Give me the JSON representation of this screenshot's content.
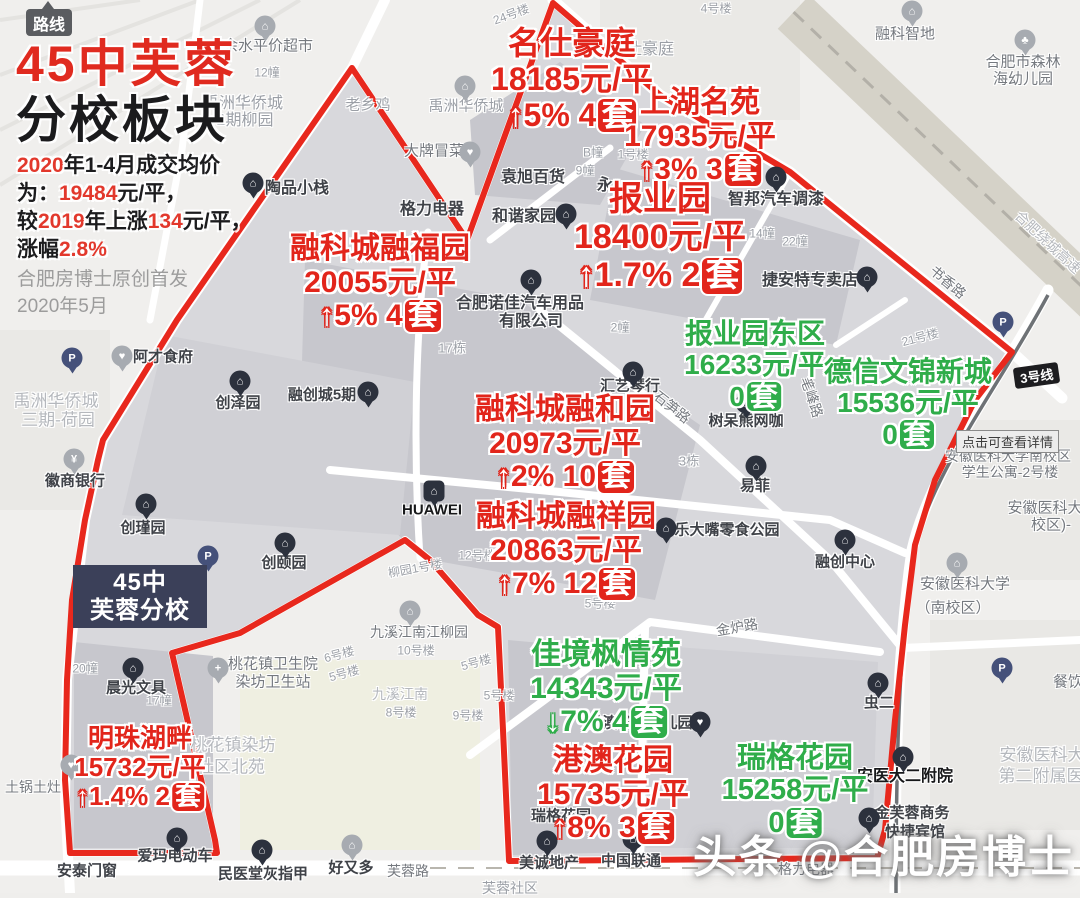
{
  "colors": {
    "red": "#e2251b",
    "green": "#2fad4a",
    "boundary": "#e8281d",
    "school_bg": "#3b4059"
  },
  "route_button": {
    "label": "路线"
  },
  "header": {
    "title_red": "45中芙蓉",
    "title_black": "分校板块",
    "summary_lines": [
      [
        {
          "t": "2020",
          "c": "r"
        },
        {
          "t": "年1-4月成交均价",
          "c": "k"
        }
      ],
      [
        {
          "t": "为：",
          "c": "k"
        },
        {
          "t": "19484",
          "c": "r"
        },
        {
          "t": "元/平，",
          "c": "k"
        }
      ],
      [
        {
          "t": "较",
          "c": "k"
        },
        {
          "t": "2019",
          "c": "r"
        },
        {
          "t": "年上涨",
          "c": "k"
        },
        {
          "t": "134",
          "c": "r"
        },
        {
          "t": "元/平，",
          "c": "k"
        }
      ],
      [
        {
          "t": "涨幅",
          "c": "k"
        },
        {
          "t": "2.8%",
          "c": "r"
        }
      ]
    ],
    "credit_lines": [
      "合肥房博士原创首发",
      "2020年5月"
    ]
  },
  "school_box": {
    "line1": "45中",
    "line2": "芙蓉分校"
  },
  "metro_badge": {
    "label": "3号线"
  },
  "detail_tooltip": {
    "label": "点击可查看详情"
  },
  "watermark": {
    "label": "头条 @合肥房博士"
  },
  "estates": [
    {
      "name": "名仕豪庭",
      "price": "18185元/平",
      "trend": "up",
      "change": "5%",
      "count": "4",
      "unit": "套",
      "color": "red",
      "cx": 572,
      "y": 26,
      "fs": 32
    },
    {
      "name": "上湖名苑",
      "price": "17935元/平",
      "trend": "up",
      "change": "3%",
      "count": "3",
      "unit": "套",
      "color": "red",
      "cx": 700,
      "y": 86,
      "fs": 30
    },
    {
      "name": "报业园",
      "price": "18400元/平",
      "trend": "up",
      "change": "1.7%",
      "count": "2",
      "unit": "套",
      "color": "red",
      "cx": 660,
      "y": 180,
      "fs": 34
    },
    {
      "name": "融科城融福园",
      "price": "20055元/平",
      "trend": "up",
      "change": "5%",
      "count": "4",
      "unit": "套",
      "color": "red",
      "cx": 380,
      "y": 232,
      "fs": 30
    },
    {
      "name": "报业园东区",
      "price": "16233元/平",
      "trend": "none",
      "change": "",
      "count": "0",
      "unit": "套",
      "color": "green",
      "cx": 755,
      "y": 318,
      "fs": 28
    },
    {
      "name": "德信文锦新城",
      "price": "15536元/平",
      "trend": "none",
      "change": "",
      "count": "0",
      "unit": "套",
      "color": "green",
      "cx": 908,
      "y": 356,
      "fs": 28
    },
    {
      "name": "融科城融和园",
      "price": "20973元/平",
      "trend": "up",
      "change": "2%",
      "count": "10",
      "unit": "套",
      "color": "red",
      "cx": 565,
      "y": 393,
      "fs": 30
    },
    {
      "name": "融科城融祥园",
      "price": "20863元/平",
      "trend": "up",
      "change": "7%",
      "count": "12",
      "unit": "套",
      "color": "red",
      "cx": 566,
      "y": 500,
      "fs": 30
    },
    {
      "name": "佳境枫情苑",
      "price": "14343元/平",
      "trend": "down",
      "change": "7%",
      "count": "4",
      "unit": "套",
      "color": "green",
      "cx": 606,
      "y": 638,
      "fs": 30
    },
    {
      "name": "港澳花园",
      "price": "15735元/平",
      "trend": "up",
      "change": "8%",
      "count": "3",
      "unit": "套",
      "color": "red",
      "cx": 613,
      "y": 744,
      "fs": 30
    },
    {
      "name": "瑞格花园",
      "price": "15258元/平",
      "trend": "none",
      "change": "",
      "count": "0",
      "unit": "套",
      "color": "green",
      "cx": 795,
      "y": 742,
      "fs": 29
    },
    {
      "name": "明珠湖畔",
      "price": "15732元/平",
      "trend": "up",
      "change": "1.4%",
      "count": "2",
      "unit": "套",
      "color": "red",
      "cx": 140,
      "y": 724,
      "fs": 26
    }
  ],
  "map_labels": [
    {
      "t": "余水平价超市",
      "x": 268,
      "y": 45,
      "fs": 15,
      "c": "gray2"
    },
    {
      "t": "禹洲华侨城",
      "x": 243,
      "y": 101,
      "fs": 16,
      "c": "gray"
    },
    {
      "t": "2期柳园",
      "x": 245,
      "y": 118,
      "fs": 16,
      "c": "gray"
    },
    {
      "t": "12幢",
      "x": 267,
      "y": 72,
      "fs": 12,
      "c": "gray"
    },
    {
      "t": "24号楼",
      "x": 511,
      "y": 14,
      "fs": 12,
      "c": "gray",
      "rot": -20
    },
    {
      "t": "4号楼",
      "x": 716,
      "y": 8,
      "fs": 12,
      "c": "gray"
    },
    {
      "t": "融科智地",
      "x": 905,
      "y": 33,
      "fs": 15,
      "c": "gray2"
    },
    {
      "t": "合肥市森林",
      "x": 1023,
      "y": 61,
      "fs": 15,
      "c": "gray2"
    },
    {
      "t": "海幼儿园",
      "x": 1023,
      "y": 78,
      "fs": 15,
      "c": "gray2"
    },
    {
      "t": "老乡鸡",
      "x": 368,
      "y": 104,
      "fs": 15,
      "c": "gray"
    },
    {
      "t": "仕豪庭",
      "x": 650,
      "y": 47,
      "fs": 16,
      "c": "gray"
    },
    {
      "t": "大牌冒菜",
      "x": 434,
      "y": 150,
      "fs": 15,
      "c": "gray2"
    },
    {
      "t": "陶品小栈",
      "x": 297,
      "y": 186,
      "fs": 16,
      "c": "dark"
    },
    {
      "t": "袁旭百货",
      "x": 533,
      "y": 175,
      "fs": 16,
      "c": "dark"
    },
    {
      "t": "B幢",
      "x": 593,
      "y": 152,
      "fs": 12,
      "c": "gray"
    },
    {
      "t": "9幢",
      "x": 585,
      "y": 170,
      "fs": 12,
      "c": "gray"
    },
    {
      "t": "1号楼",
      "x": 633,
      "y": 154,
      "fs": 12,
      "c": "gray"
    },
    {
      "t": "永",
      "x": 605,
      "y": 183,
      "fs": 16,
      "c": "dark"
    },
    {
      "t": "和谐家园",
      "x": 524,
      "y": 214,
      "fs": 16,
      "c": "dark"
    },
    {
      "t": "格力电器",
      "x": 432,
      "y": 207,
      "fs": 16,
      "c": "dark"
    },
    {
      "t": "智邦汽车调漆",
      "x": 776,
      "y": 197,
      "fs": 16,
      "c": "dark"
    },
    {
      "t": "14幢",
      "x": 762,
      "y": 233,
      "fs": 12,
      "c": "gray"
    },
    {
      "t": "22幢",
      "x": 795,
      "y": 241,
      "fs": 12,
      "c": "gray"
    },
    {
      "t": "捷安特专卖店",
      "x": 810,
      "y": 278,
      "fs": 16,
      "c": "dark"
    },
    {
      "t": "书香路",
      "x": 948,
      "y": 282,
      "fs": 14,
      "c": "gray2",
      "rot": 40
    },
    {
      "t": "合肥绕城高速",
      "x": 1048,
      "y": 242,
      "fs": 14,
      "c": "gray3",
      "rot": 43
    },
    {
      "t": "21号楼",
      "x": 920,
      "y": 337,
      "fs": 12,
      "c": "gray",
      "rot": -15
    },
    {
      "t": "2幢",
      "x": 620,
      "y": 327,
      "fs": 12,
      "c": "gray"
    },
    {
      "t": "合肥诺佳汽车用品",
      "x": 520,
      "y": 301,
      "fs": 16,
      "c": "dark"
    },
    {
      "t": "有限公司",
      "x": 531,
      "y": 319,
      "fs": 16,
      "c": "dark"
    },
    {
      "t": "17栋",
      "x": 452,
      "y": 347,
      "fs": 13,
      "c": "gray"
    },
    {
      "t": "禹洲华侨城",
      "x": 466,
      "y": 105,
      "fs": 15,
      "c": "gray"
    },
    {
      "t": "汇艺琴行",
      "x": 630,
      "y": 385,
      "fs": 15,
      "c": "dark"
    },
    {
      "t": "石笋路",
      "x": 672,
      "y": 407,
      "fs": 14,
      "c": "gray2",
      "rot": 38
    },
    {
      "t": "树呆熊网咖",
      "x": 746,
      "y": 420,
      "fs": 15,
      "c": "dark"
    },
    {
      "t": "笔峰路",
      "x": 812,
      "y": 397,
      "fs": 14,
      "c": "gray2",
      "rot": 72
    },
    {
      "t": "3栋",
      "x": 689,
      "y": 460,
      "fs": 13,
      "c": "gray"
    },
    {
      "t": "易菲",
      "x": 755,
      "y": 485,
      "fs": 15,
      "c": "dark"
    },
    {
      "t": "乐大嘴零食公园",
      "x": 727,
      "y": 529,
      "fs": 15,
      "c": "dark"
    },
    {
      "t": "融创中心",
      "x": 845,
      "y": 561,
      "fs": 15,
      "c": "dark"
    },
    {
      "t": "融创城5期",
      "x": 322,
      "y": 394,
      "fs": 15,
      "c": "dark"
    },
    {
      "t": "创泽园",
      "x": 238,
      "y": 402,
      "fs": 15,
      "c": "dark"
    },
    {
      "t": "阿才食府",
      "x": 163,
      "y": 356,
      "fs": 15,
      "c": "dark"
    },
    {
      "t": "禹洲华侨城",
      "x": 56,
      "y": 399,
      "fs": 17,
      "c": "gray3"
    },
    {
      "t": "三期-荷园",
      "x": 58,
      "y": 418,
      "fs": 17,
      "c": "gray3"
    },
    {
      "t": "徽商银行",
      "x": 75,
      "y": 480,
      "fs": 15,
      "c": "dark"
    },
    {
      "t": "创瑾园",
      "x": 143,
      "y": 527,
      "fs": 15,
      "c": "dark"
    },
    {
      "t": "创颐园",
      "x": 284,
      "y": 562,
      "fs": 15,
      "c": "dark"
    },
    {
      "t": "HUAWEI",
      "x": 432,
      "y": 510,
      "fs": 15,
      "c": "black"
    },
    {
      "t": "12号楼",
      "x": 477,
      "y": 555,
      "fs": 12,
      "c": "gray"
    },
    {
      "t": "柳园1号楼",
      "x": 415,
      "y": 568,
      "fs": 12,
      "c": "gray",
      "rot": -10
    },
    {
      "t": "5号楼",
      "x": 600,
      "y": 603,
      "fs": 12,
      "c": "gray"
    },
    {
      "t": "九溪江南江柳园",
      "x": 419,
      "y": 632,
      "fs": 14,
      "c": "gray2"
    },
    {
      "t": "10号楼",
      "x": 416,
      "y": 650,
      "fs": 12,
      "c": "gray"
    },
    {
      "t": "5号楼",
      "x": 476,
      "y": 662,
      "fs": 12,
      "c": "gray",
      "rot": -15
    },
    {
      "t": "5号楼",
      "x": 499,
      "y": 695,
      "fs": 12,
      "c": "gray"
    },
    {
      "t": "9号楼",
      "x": 468,
      "y": 715,
      "fs": 12,
      "c": "gray"
    },
    {
      "t": "九溪江南",
      "x": 400,
      "y": 694,
      "fs": 14,
      "c": "gray3"
    },
    {
      "t": "8号楼",
      "x": 401,
      "y": 712,
      "fs": 12,
      "c": "gray"
    },
    {
      "t": "6号楼",
      "x": 339,
      "y": 654,
      "fs": 12,
      "c": "gray",
      "rot": -15
    },
    {
      "t": "5号楼",
      "x": 344,
      "y": 673,
      "fs": 12,
      "c": "gray",
      "rot": -15
    },
    {
      "t": "桃花镇卫生院",
      "x": 273,
      "y": 663,
      "fs": 15,
      "c": "gray2"
    },
    {
      "t": "染坊卫生站",
      "x": 273,
      "y": 681,
      "fs": 15,
      "c": "gray2"
    },
    {
      "t": "桃花镇染坊",
      "x": 233,
      "y": 743,
      "fs": 17,
      "c": "gray3"
    },
    {
      "t": "社区北苑",
      "x": 231,
      "y": 765,
      "fs": 17,
      "c": "gray3"
    },
    {
      "t": "17幢",
      "x": 159,
      "y": 700,
      "fs": 12,
      "c": "gray"
    },
    {
      "t": "20幢",
      "x": 85,
      "y": 668,
      "fs": 12,
      "c": "gray"
    },
    {
      "t": "晨光文具",
      "x": 136,
      "y": 687,
      "fs": 15,
      "c": "dark"
    },
    {
      "t": "土锅土灶",
      "x": 33,
      "y": 787,
      "fs": 14,
      "c": "gray2"
    },
    {
      "t": "爱玛电动车",
      "x": 175,
      "y": 855,
      "fs": 15,
      "c": "dark"
    },
    {
      "t": "安泰门窗",
      "x": 87,
      "y": 870,
      "fs": 15,
      "c": "dark"
    },
    {
      "t": "民医堂灰指甲",
      "x": 263,
      "y": 873,
      "fs": 15,
      "c": "dark"
    },
    {
      "t": "好又多",
      "x": 351,
      "y": 867,
      "fs": 15,
      "c": "dark"
    },
    {
      "t": "芙蓉路",
      "x": 408,
      "y": 871,
      "fs": 14,
      "c": "gray2"
    },
    {
      "t": "芙蓉社区",
      "x": 510,
      "y": 888,
      "fs": 14,
      "c": "gray"
    },
    {
      "t": "美诚地产",
      "x": 549,
      "y": 862,
      "fs": 15,
      "c": "dark"
    },
    {
      "t": "中国联通",
      "x": 631,
      "y": 860,
      "fs": 15,
      "c": "dark"
    },
    {
      "t": "瑞格花园",
      "x": 561,
      "y": 815,
      "fs": 15,
      "c": "dark"
    },
    {
      "t": "格力电器",
      "x": 806,
      "y": 869,
      "fs": 14,
      "c": "gray2"
    },
    {
      "t": "金炉路",
      "x": 737,
      "y": 627,
      "fs": 14,
      "c": "gray2",
      "rot": -10
    },
    {
      "t": "港澳花园幼儿园",
      "x": 640,
      "y": 722,
      "fs": 15,
      "c": "dark"
    },
    {
      "t": "虫二",
      "x": 879,
      "y": 702,
      "fs": 15,
      "c": "dark"
    },
    {
      "t": "安医大二附院",
      "x": 905,
      "y": 774,
      "fs": 16,
      "c": "black"
    },
    {
      "t": "金芙蓉商务",
      "x": 912,
      "y": 812,
      "fs": 15,
      "c": "dark"
    },
    {
      "t": "快捷宾馆",
      "x": 915,
      "y": 831,
      "fs": 15,
      "c": "dark"
    },
    {
      "t": "餐饮",
      "x": 1068,
      "y": 681,
      "fs": 15,
      "c": "gray2"
    },
    {
      "t": "安徽医科大",
      "x": 1042,
      "y": 753,
      "fs": 17,
      "c": "gray3"
    },
    {
      "t": "第二附属医",
      "x": 1041,
      "y": 774,
      "fs": 17,
      "c": "gray3"
    },
    {
      "t": "安徽医科大学",
      "x": 965,
      "y": 583,
      "fs": 15,
      "c": "gray2"
    },
    {
      "t": "（南校区）",
      "x": 953,
      "y": 607,
      "fs": 15,
      "c": "gray2"
    },
    {
      "t": "安徽医科大",
      "x": 1045,
      "y": 507,
      "fs": 15,
      "c": "gray2"
    },
    {
      "t": "校区)-",
      "x": 1051,
      "y": 524,
      "fs": 15,
      "c": "gray2"
    },
    {
      "t": "安徽医科大学南校区",
      "x": 1008,
      "y": 456,
      "fs": 14,
      "c": "gray2"
    },
    {
      "t": "学生公寓-2号楼",
      "x": 1010,
      "y": 472,
      "fs": 14,
      "c": "gray2"
    }
  ],
  "pois": [
    {
      "name": "building-pin",
      "x": 253,
      "y": 183,
      "type": "dark",
      "glyph": "⌂"
    },
    {
      "name": "building-pin",
      "x": 566,
      "y": 214,
      "type": "dark",
      "glyph": "⌂"
    },
    {
      "name": "building-pin",
      "x": 776,
      "y": 177,
      "type": "dark",
      "glyph": "⌂"
    },
    {
      "name": "building-pin",
      "x": 867,
      "y": 277,
      "type": "dark",
      "glyph": "⌂"
    },
    {
      "name": "building-pin",
      "x": 531,
      "y": 280,
      "type": "dark",
      "glyph": "⌂"
    },
    {
      "name": "building-pin",
      "x": 633,
      "y": 372,
      "type": "dark",
      "glyph": "⌂"
    },
    {
      "name": "building-pin",
      "x": 746,
      "y": 403,
      "type": "dark",
      "glyph": "⌂"
    },
    {
      "name": "building-pin",
      "x": 756,
      "y": 466,
      "type": "dark",
      "glyph": "⌂"
    },
    {
      "name": "building-pin",
      "x": 666,
      "y": 528,
      "type": "dark",
      "glyph": "⌂"
    },
    {
      "name": "building-pin",
      "x": 845,
      "y": 540,
      "type": "dark",
      "glyph": "⌂"
    },
    {
      "name": "building-pin",
      "x": 368,
      "y": 392,
      "type": "dark",
      "glyph": "⌂"
    },
    {
      "name": "building-pin",
      "x": 240,
      "y": 381,
      "type": "dark",
      "glyph": "⌂"
    },
    {
      "name": "building-pin",
      "x": 146,
      "y": 504,
      "type": "dark",
      "glyph": "⌂"
    },
    {
      "name": "building-pin",
      "x": 285,
      "y": 543,
      "type": "dark",
      "glyph": "⌂"
    },
    {
      "name": "huawei-store-pin",
      "x": 434,
      "y": 491,
      "type": "square",
      "glyph": "⌂"
    },
    {
      "name": "building-pin",
      "x": 133,
      "y": 668,
      "type": "dark",
      "glyph": "⌂"
    },
    {
      "name": "building-pin",
      "x": 177,
      "y": 838,
      "type": "dark",
      "glyph": "⌂"
    },
    {
      "name": "building-pin",
      "x": 262,
      "y": 850,
      "type": "dark",
      "glyph": "⌂"
    },
    {
      "name": "building-pin",
      "x": 547,
      "y": 841,
      "type": "dark",
      "glyph": "⌂"
    },
    {
      "name": "building-pin",
      "x": 633,
      "y": 839,
      "type": "dark",
      "glyph": "⌂"
    },
    {
      "name": "kindergarten-pin",
      "x": 700,
      "y": 722,
      "type": "dark",
      "glyph": "♥"
    },
    {
      "name": "building-pin",
      "x": 878,
      "y": 683,
      "type": "dark",
      "glyph": "⌂"
    },
    {
      "name": "hospital-pin",
      "x": 903,
      "y": 757,
      "type": "dark",
      "glyph": "⌂"
    },
    {
      "name": "building-pin",
      "x": 869,
      "y": 818,
      "type": "dark",
      "glyph": "⌂"
    },
    {
      "name": "supermarket-pin",
      "x": 265,
      "y": 26,
      "type": "gray",
      "glyph": "⌂"
    },
    {
      "name": "building-pin",
      "x": 912,
      "y": 11,
      "type": "gray",
      "glyph": "⌂"
    },
    {
      "name": "building-pin",
      "x": 465,
      "y": 86,
      "type": "gray",
      "glyph": "⌂"
    },
    {
      "name": "food-pin",
      "x": 470,
      "y": 152,
      "type": "gray",
      "glyph": "♥"
    },
    {
      "name": "food-pin",
      "x": 122,
      "y": 356,
      "type": "gray",
      "glyph": "♥"
    },
    {
      "name": "bank-pin",
      "x": 74,
      "y": 459,
      "type": "gray",
      "glyph": "¥"
    },
    {
      "name": "clinic-pin",
      "x": 218,
      "y": 668,
      "type": "gray",
      "glyph": "+"
    },
    {
      "name": "building-pin",
      "x": 410,
      "y": 611,
      "type": "gray",
      "glyph": "⌂"
    },
    {
      "name": "building-pin",
      "x": 352,
      "y": 845,
      "type": "gray",
      "glyph": "⌂"
    },
    {
      "name": "food-pin",
      "x": 71,
      "y": 765,
      "type": "gray",
      "glyph": "♥"
    },
    {
      "name": "school-pin",
      "x": 957,
      "y": 563,
      "type": "gray",
      "glyph": "⌂"
    },
    {
      "name": "kindergarten-pin",
      "x": 1025,
      "y": 40,
      "type": "gray",
      "glyph": "♣"
    },
    {
      "name": "parking-pin",
      "x": 208,
      "y": 556,
      "type": "p",
      "glyph": "P"
    },
    {
      "name": "parking-pin",
      "x": 1003,
      "y": 322,
      "type": "p",
      "glyph": "P"
    },
    {
      "name": "parking-pin",
      "x": 1002,
      "y": 668,
      "type": "p",
      "glyph": "P"
    },
    {
      "name": "parking-pin",
      "x": 72,
      "y": 358,
      "type": "p",
      "glyph": "P"
    }
  ]
}
